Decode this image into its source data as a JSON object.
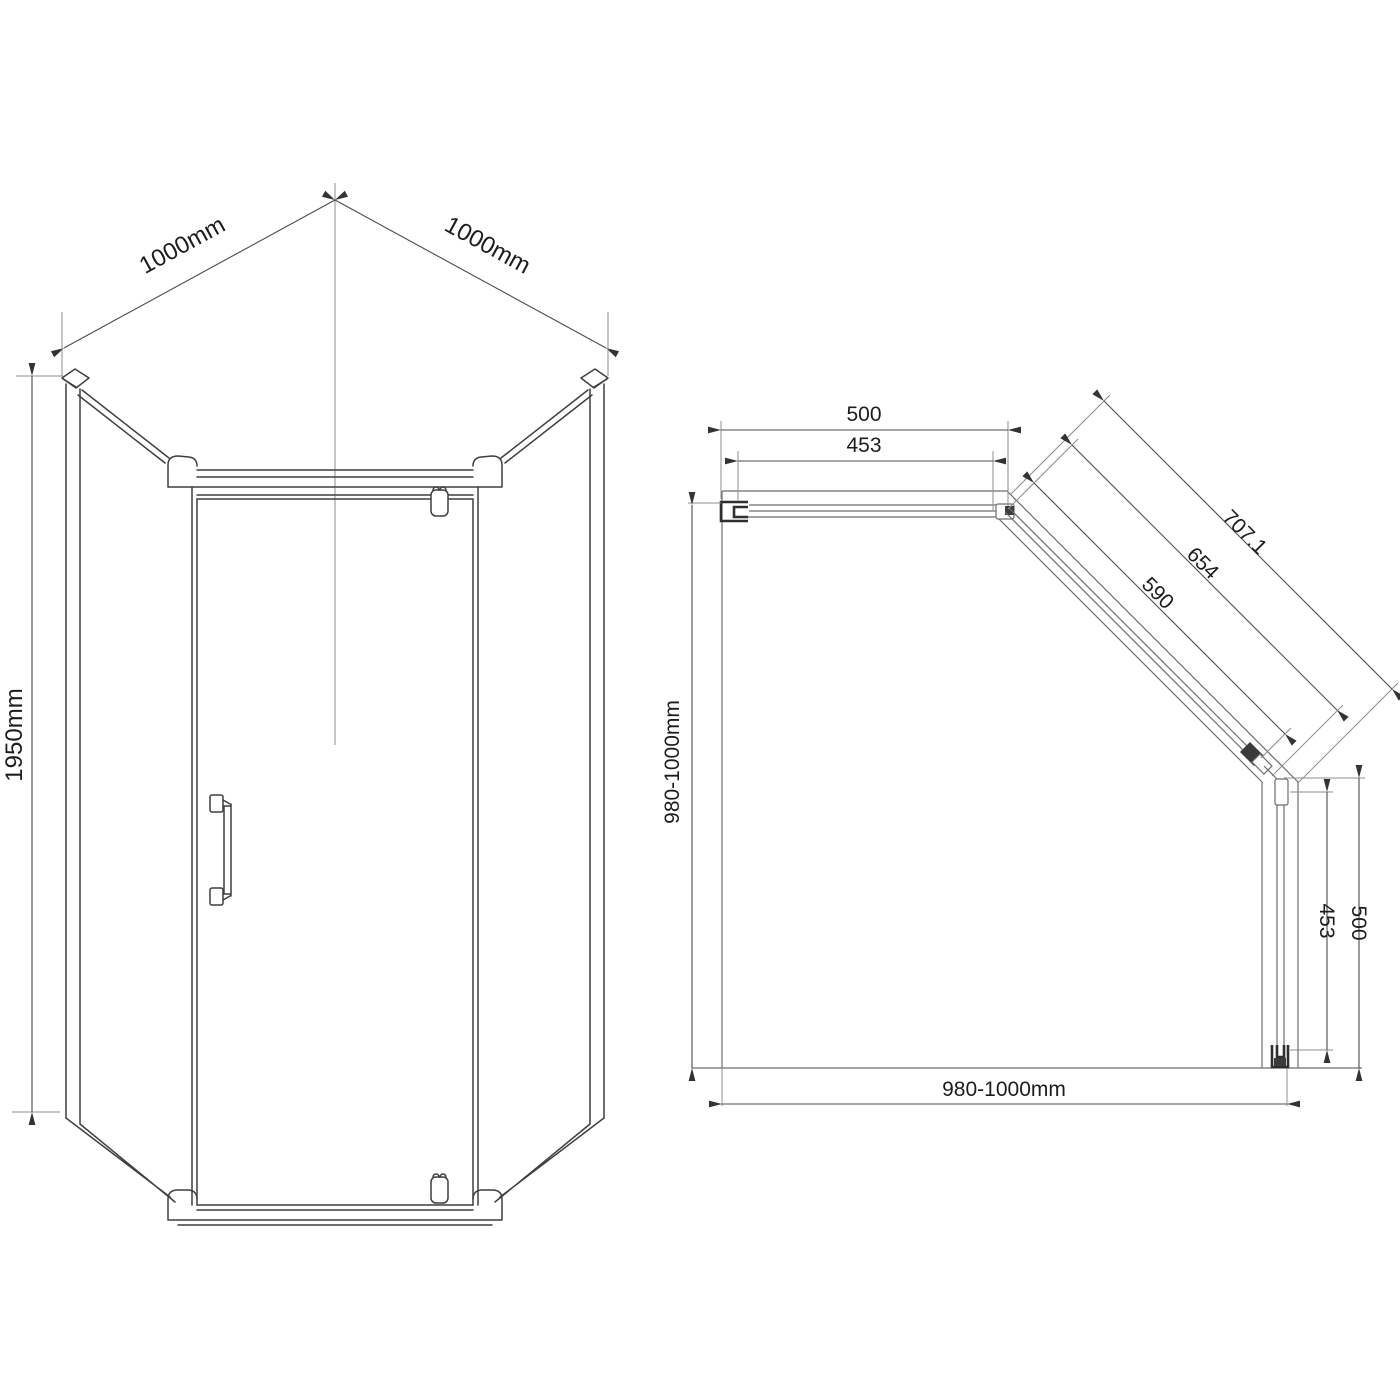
{
  "front_view": {
    "dim_width_left": "1000mm",
    "dim_width_right": "1000mm",
    "dim_height": "1950mm"
  },
  "plan_view": {
    "dim_top_outer": "500",
    "dim_top_inner": "453",
    "dim_diag_outer": "707.1",
    "dim_diag_mid": "654",
    "dim_diag_inner": "590",
    "dim_side_left": "980-1000mm",
    "dim_bottom": "980-1000mm",
    "dim_right_inner": "453",
    "dim_right_outer": "500"
  },
  "colors": {
    "background": "#ffffff",
    "drawing_line": "#3f3f3f",
    "plan_line": "#6e6e6e",
    "dimension_line": "#4c4c4c",
    "extension_line": "#8d8d8d",
    "text": "#1c1c1c"
  }
}
